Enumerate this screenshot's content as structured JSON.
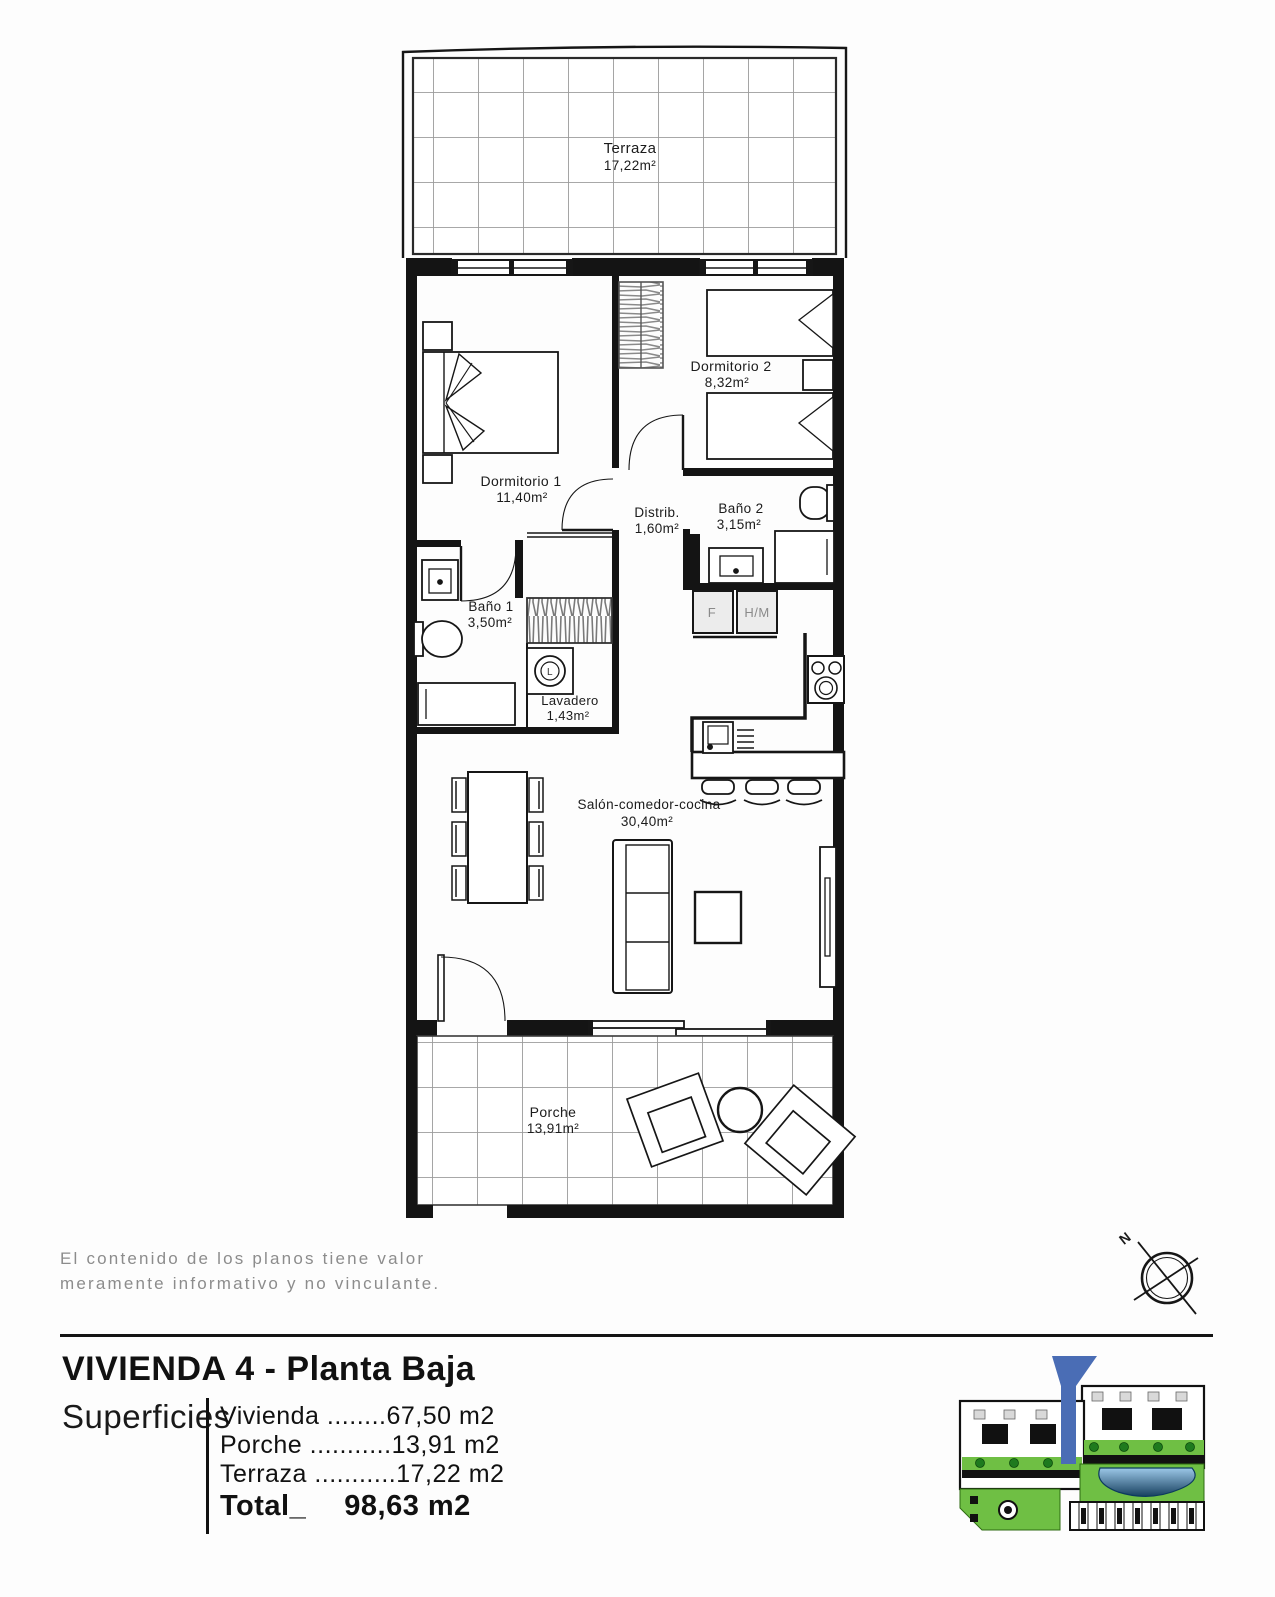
{
  "plan": {
    "rooms": [
      {
        "id": "terraza",
        "name": "Terraza",
        "area": "17,22m²"
      },
      {
        "id": "dormitorio1",
        "name": "Dormitorio 1",
        "area": "11,40m²"
      },
      {
        "id": "dormitorio2",
        "name": "Dormitorio 2",
        "area": "8,32m²"
      },
      {
        "id": "distribuidor",
        "name": "Distrib.",
        "area": "1,60m²"
      },
      {
        "id": "bano1",
        "name": "Baño 1",
        "area": "3,50m²"
      },
      {
        "id": "bano2",
        "name": "Baño 2",
        "area": "3,15m²"
      },
      {
        "id": "lavadero",
        "name": "Lavadero",
        "area": "1,43m²"
      },
      {
        "id": "salon",
        "name": "Salón-comedor-cocina",
        "area": "30,40m²"
      },
      {
        "id": "porche",
        "name": "Porche",
        "area": "13,91m²"
      }
    ],
    "labels": {
      "fridge": "F",
      "oven_micro": "H/M",
      "washer": "L"
    },
    "compass": "N"
  },
  "disclaimer": {
    "line1": "El contenido de los planos tiene valor",
    "line2": "meramente informativo y no vinculante."
  },
  "footer": {
    "title": "VIVIENDA 4 - Planta Baja",
    "surfaces_label": "Superficies",
    "rows": [
      {
        "label": "Vivienda ",
        "leader": "........",
        "value": "67,50 m2"
      },
      {
        "label": "Porche ",
        "leader": "...........",
        "value": "13,91 m2"
      },
      {
        "label": "Terraza ",
        "leader": "...........",
        "value": "17,22 m2"
      }
    ],
    "total_label": "Total_",
    "total_value": "98,63 m2"
  },
  "colors": {
    "wall": "#141414",
    "tile_grid": "#9b9b9b",
    "label_gray": "#8a8a8a",
    "site_green": "#6fbf44",
    "site_pool_dark": "#17405f",
    "marker_blue": "#4a6db5"
  }
}
